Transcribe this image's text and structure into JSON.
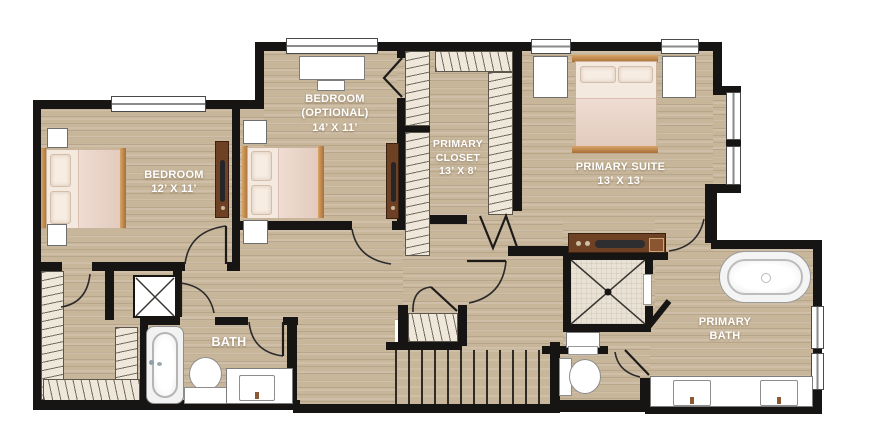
{
  "plan": {
    "type": "floor-plan",
    "rooms": [
      {
        "id": "bedroom",
        "lines": [
          "BEDROOM",
          "12’ X 11’"
        ]
      },
      {
        "id": "bedroom-optional",
        "lines": [
          "BEDROOM",
          "(OPTIONAL)",
          "14’ X 11’"
        ]
      },
      {
        "id": "primary-closet",
        "lines": [
          "PRIMARY",
          "CLOSET",
          "13’ X 8’"
        ]
      },
      {
        "id": "primary-suite",
        "lines": [
          "PRIMARY SUITE",
          "13’ X 13’"
        ]
      },
      {
        "id": "bath",
        "lines": [
          "BATH"
        ]
      },
      {
        "id": "primary-bath",
        "lines": [
          "PRIMARY",
          "BATH"
        ]
      }
    ],
    "colors": {
      "wall": "#171513",
      "floor": "#c8b69b",
      "shelf": "#efe8da",
      "tile": "#e9e1d3",
      "label": "#ffffff",
      "wood-trim": "#bf8851",
      "dresser": "#6e4124",
      "blanket": "#e5cfc2"
    },
    "fixtures": [
      "bed",
      "nightstand",
      "desk",
      "chair",
      "dresser",
      "washer-dryer-box",
      "bathtub",
      "toilet",
      "sink-vanity",
      "shower",
      "freestanding-tub",
      "double-vanity",
      "staircase",
      "linen-closet",
      "window",
      "door"
    ]
  }
}
